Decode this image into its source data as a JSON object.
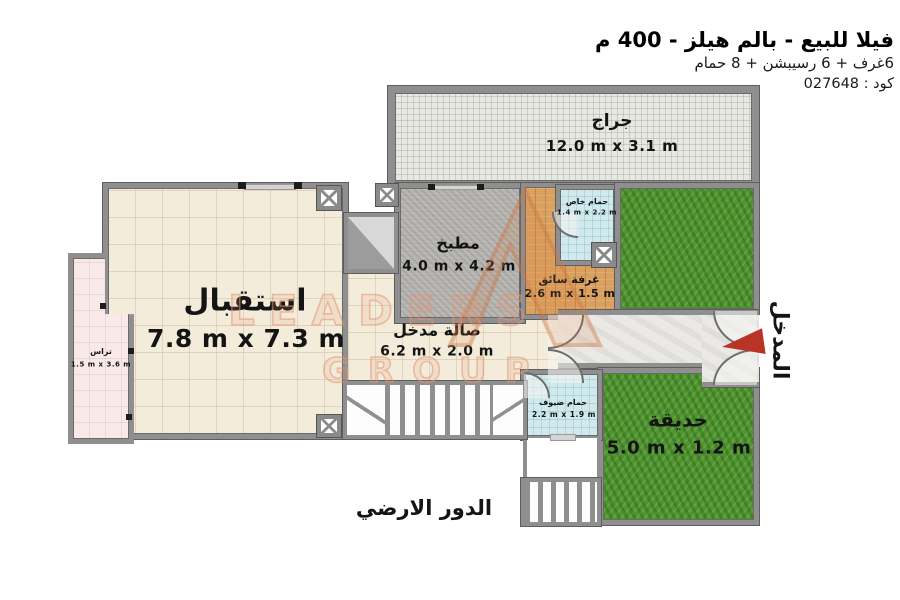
{
  "header": {
    "title": "فيلا للبيع - بالم هيلز - 400 م",
    "subtitle": "6غرف + 6 رسيبشن + 8 حمام",
    "code": "كود : 027648"
  },
  "rooms": {
    "garage": {
      "label": "جراج",
      "dims": "12.0 m x 3.1 m"
    },
    "reception": {
      "label": "استقبال",
      "dims": "7.8 m x 7.3 m"
    },
    "kitchen": {
      "label": "مطبخ",
      "dims": "4.0 m x 4.2 m"
    },
    "private_bath": {
      "label": "حمام خاص",
      "dims": "1.4 m x 2.2 m"
    },
    "driver_room": {
      "label": "غرفة سائق",
      "dims": "2.6 m x 1.5 m"
    },
    "entry_hall": {
      "label": "صالة مدخل",
      "dims": "6.2 m x 2.0 m"
    },
    "terrace": {
      "label": "تراس",
      "dims": "1.5 m x 3.6 m"
    },
    "guest_bath": {
      "label": "حمام ضيوف",
      "dims": "2.2 m x 1.9 m"
    },
    "garden": {
      "label": "حديقة",
      "dims": "5.0 m x 1.2 m"
    }
  },
  "entrance": {
    "label": "المدخل"
  },
  "floor": {
    "label": "الدور الارضي"
  },
  "watermark": {
    "line1": "LEADERS",
    "line2": "GROUP"
  },
  "colors": {
    "wall": "#8f8f8f",
    "reception_floor": "#f3ecda",
    "garage_floor": "#e8e8e2",
    "kitchen_floor": "#b7b5b1",
    "bath_floor": "#cfe9ec",
    "terrace_floor": "#f9e9e9",
    "wood_floor": "#d9a05f",
    "grass": "#4f9332",
    "pathway": "#eae9e5",
    "entrance_arrow": "#b93326",
    "watermark": "#e29674"
  }
}
